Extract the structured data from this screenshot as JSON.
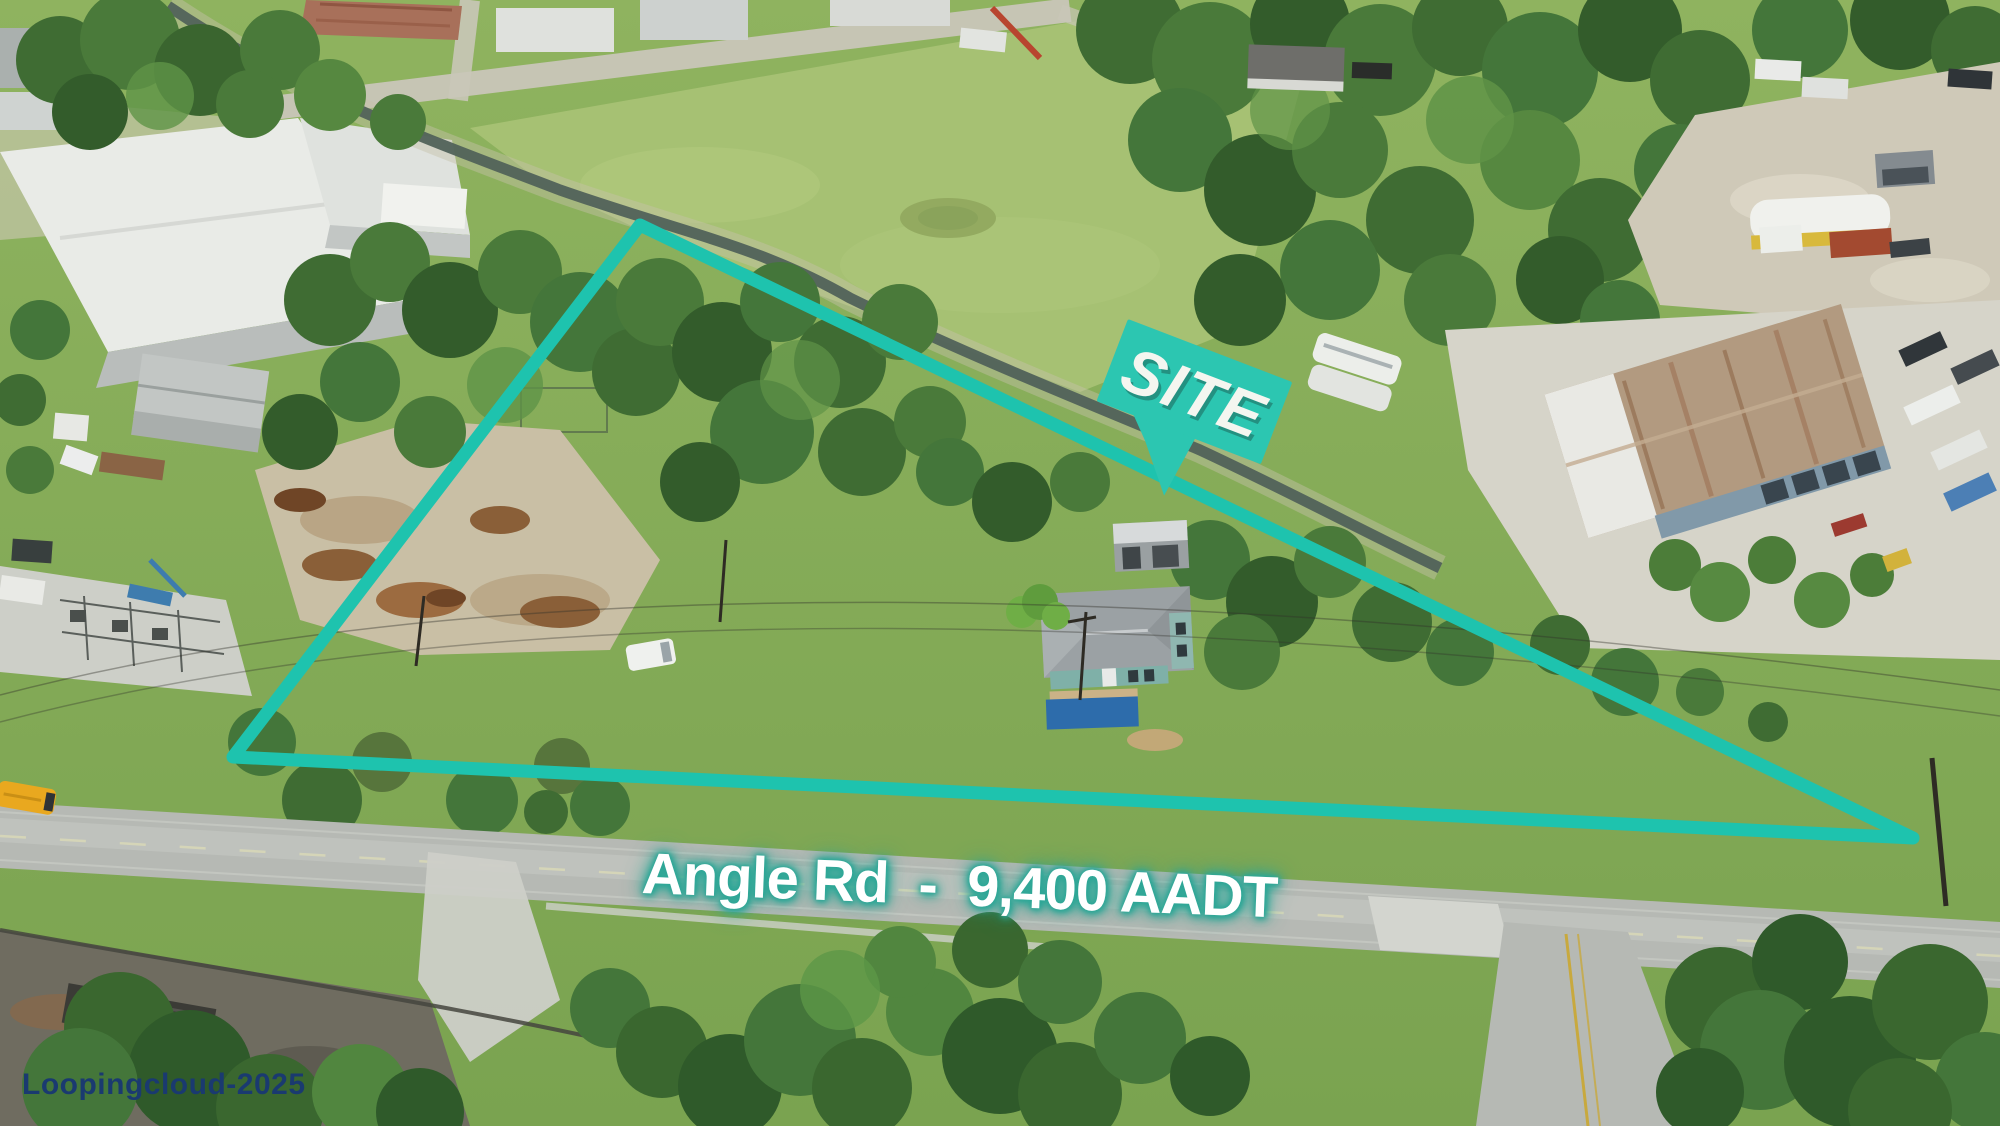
{
  "annotations": {
    "boundary": {
      "shape": "triangle",
      "color": "#1ec3ae",
      "stroke_width": 13,
      "points": "640,225 233,757 1913,838"
    },
    "site_label": {
      "text": "SITE",
      "box_color": "#2cc6b1",
      "text_color": "#f4f6f0",
      "rotation_deg": 21
    },
    "road_label": {
      "text": "Angle Rd  -  9,400 AADT",
      "road_name": "Angle Rd",
      "traffic_count": "9,400 AADT",
      "text_color": "#ffffff",
      "glow_color": "#2ea797"
    },
    "watermark": {
      "text": "Loopingcloud-2025",
      "color": "#1a3a70"
    }
  }
}
